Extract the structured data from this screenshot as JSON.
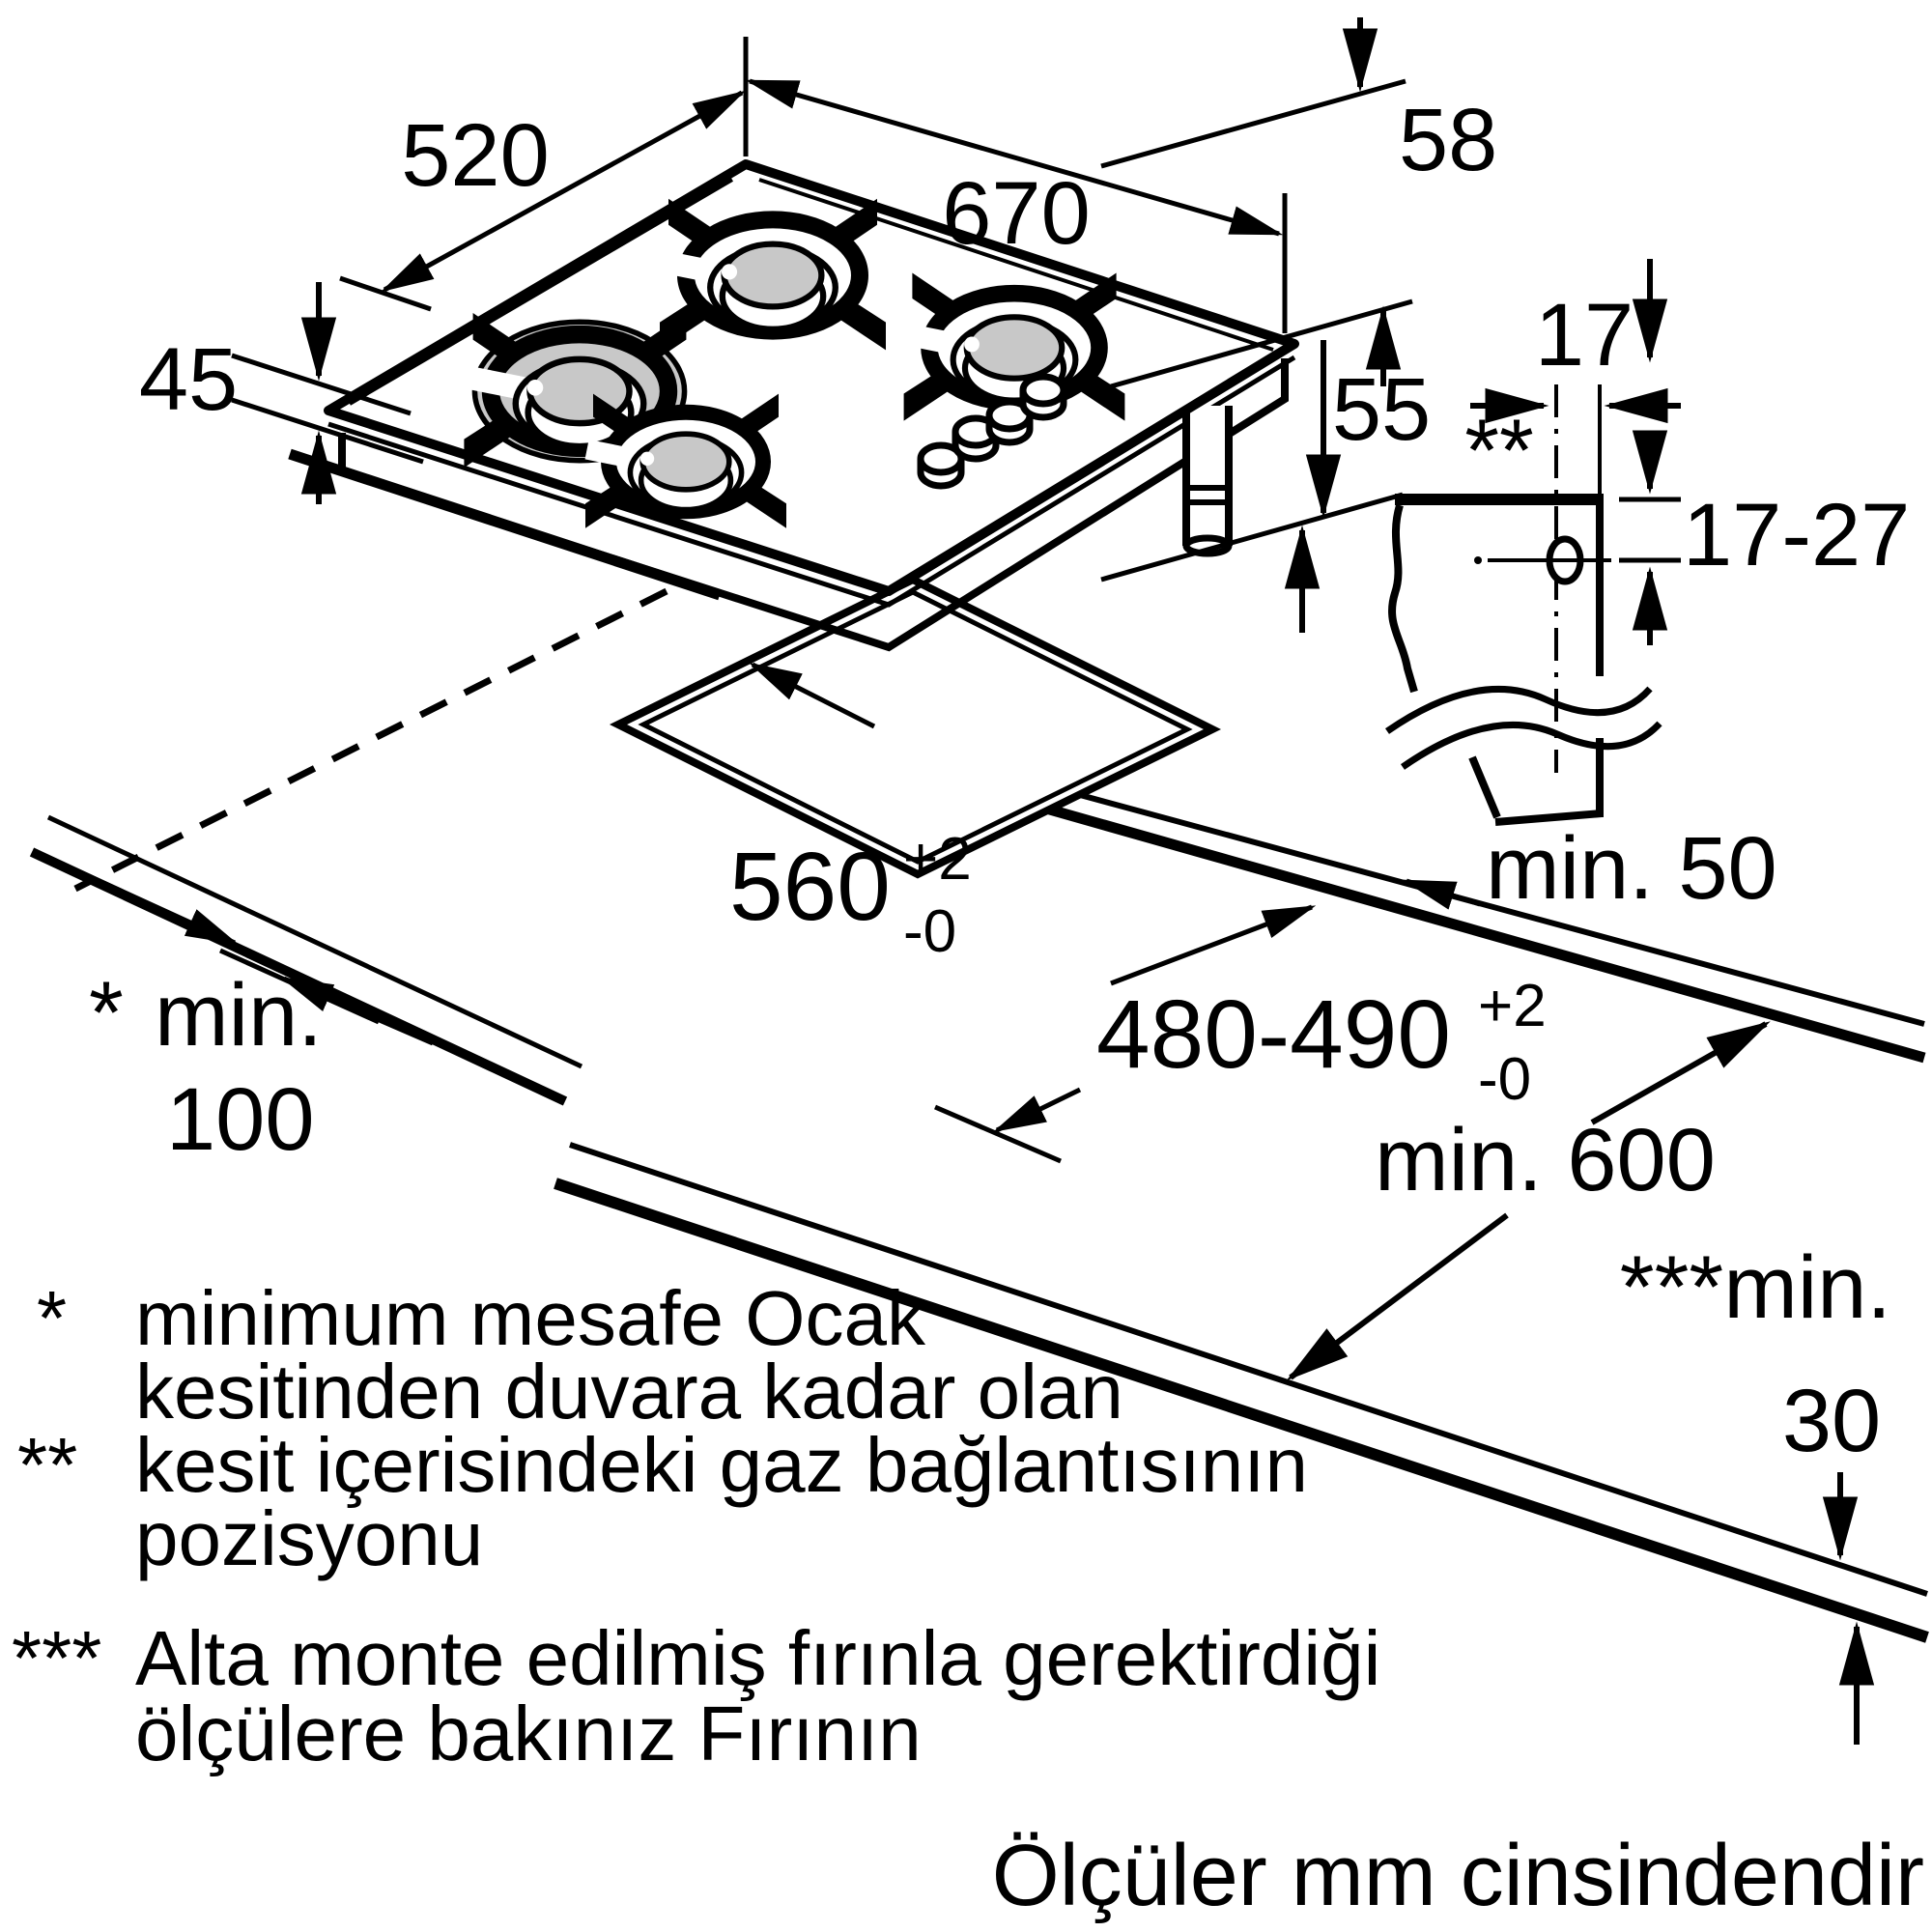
{
  "drawing_title": "gas-hob-installation-diagram",
  "hob": {
    "width_label": "670",
    "depth_label": "520",
    "height_label": "45",
    "support_height_label": "58",
    "gas_drop_label": "55"
  },
  "section_detail": {
    "edge_offset_label": "17",
    "marker": "**",
    "hole_depth_label": "17-27"
  },
  "cutout": {
    "width": {
      "value": "560",
      "tol_plus": "+2",
      "tol_minus": "-0"
    },
    "depth": {
      "value": "480-490",
      "tol_plus": "+2",
      "tol_minus": "-0"
    }
  },
  "clearances": {
    "side_label": "min. 50",
    "wall": {
      "star": "*",
      "label": "min.",
      "value": "100"
    },
    "worktop_depth_label": "min. 600",
    "front": {
      "stars_label": "***min.",
      "value": "30"
    }
  },
  "footnotes": {
    "f1": {
      "marker": "*",
      "line1": "minimum mesafe Ocak",
      "line2": "kesitinden duvara kadar olan"
    },
    "f2": {
      "marker": "**",
      "line1": "kesit içerisindeki gaz bağlantısının",
      "line2": "pozisyonu"
    },
    "f3": {
      "marker": "***",
      "line1": "Alta monte edilmiş fırınla gerektirdiği",
      "line2": "ölçülere bakınız Fırının"
    }
  },
  "units_note": "Ölçüler mm cinsindendir"
}
